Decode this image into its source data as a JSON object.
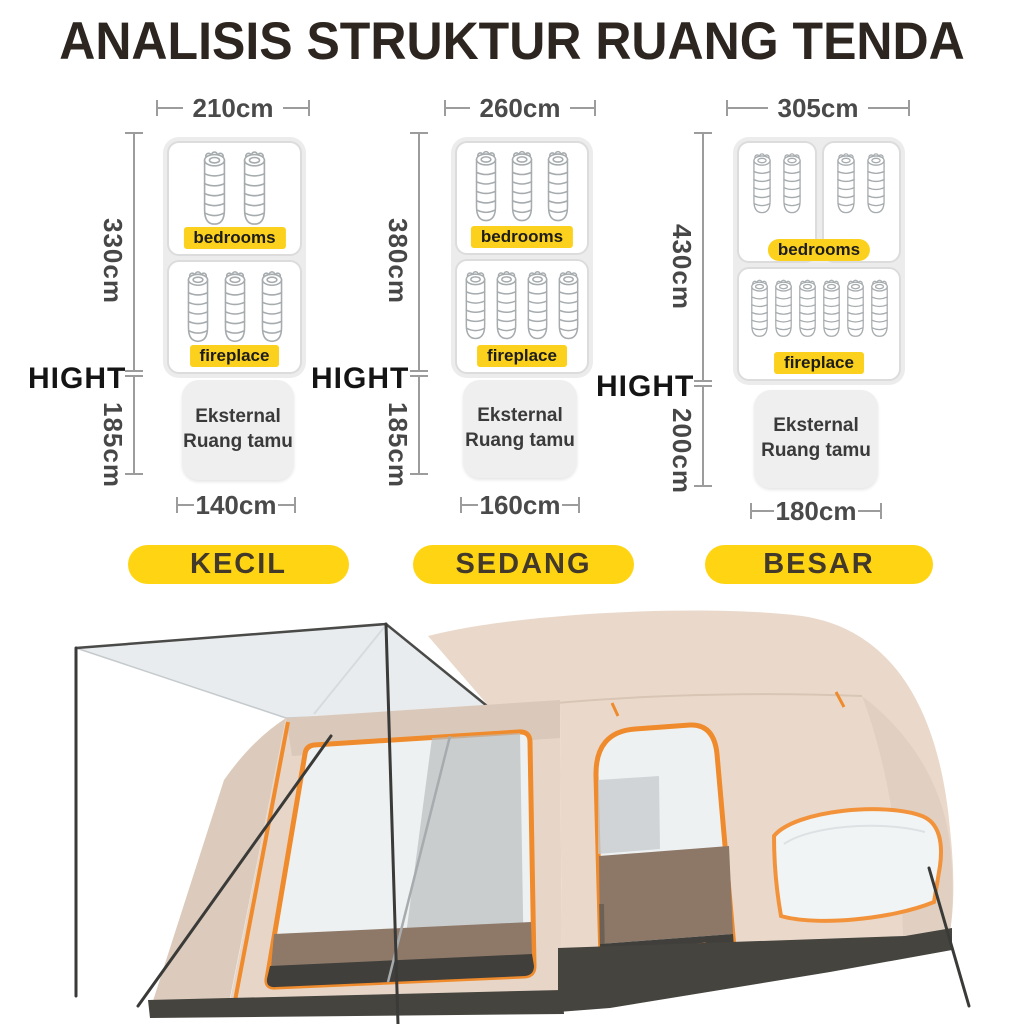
{
  "title": "ANALISIS STRUKTUR RUANG TENDA",
  "height_axis_label": "HIGHT",
  "section_labels": {
    "bedrooms": "bedrooms",
    "fireplace": "fireplace",
    "external_line1": "Eksternal",
    "external_line2": "Ruang tamu"
  },
  "sizes": [
    {
      "label": "KECIL",
      "top_width": "210cm",
      "inner_height": "330cm",
      "external_height": "185cm",
      "bottom_width": "140cm",
      "bedroom_rooms": 1,
      "bedroom_bags": 2,
      "fireplace_bags": 3
    },
    {
      "label": "SEDANG",
      "top_width": "260cm",
      "inner_height": "380cm",
      "external_height": "185cm",
      "bottom_width": "160cm",
      "bedroom_rooms": 1,
      "bedroom_bags": 3,
      "fireplace_bags": 4
    },
    {
      "label": "BESAR",
      "top_width": "305cm",
      "inner_height": "430cm",
      "external_height": "200cm",
      "bottom_width": "180cm",
      "bedroom_rooms": 2,
      "bedroom_bags": 4,
      "fireplace_bags": 6
    }
  ],
  "icons": {
    "sleeping_bag": "sleeping-bag-icon"
  },
  "colors": {
    "accent_yellow": "#fcd11d",
    "pill_yellow": "#ffd513",
    "title_text": "#2c2520",
    "dimension_text": "#4a4a4a",
    "line_gray": "#9c9c9c",
    "tent_fabric": "#ead9cb",
    "tent_trim_orange": "#ef8b2c",
    "tent_skirt": "#45443e"
  }
}
